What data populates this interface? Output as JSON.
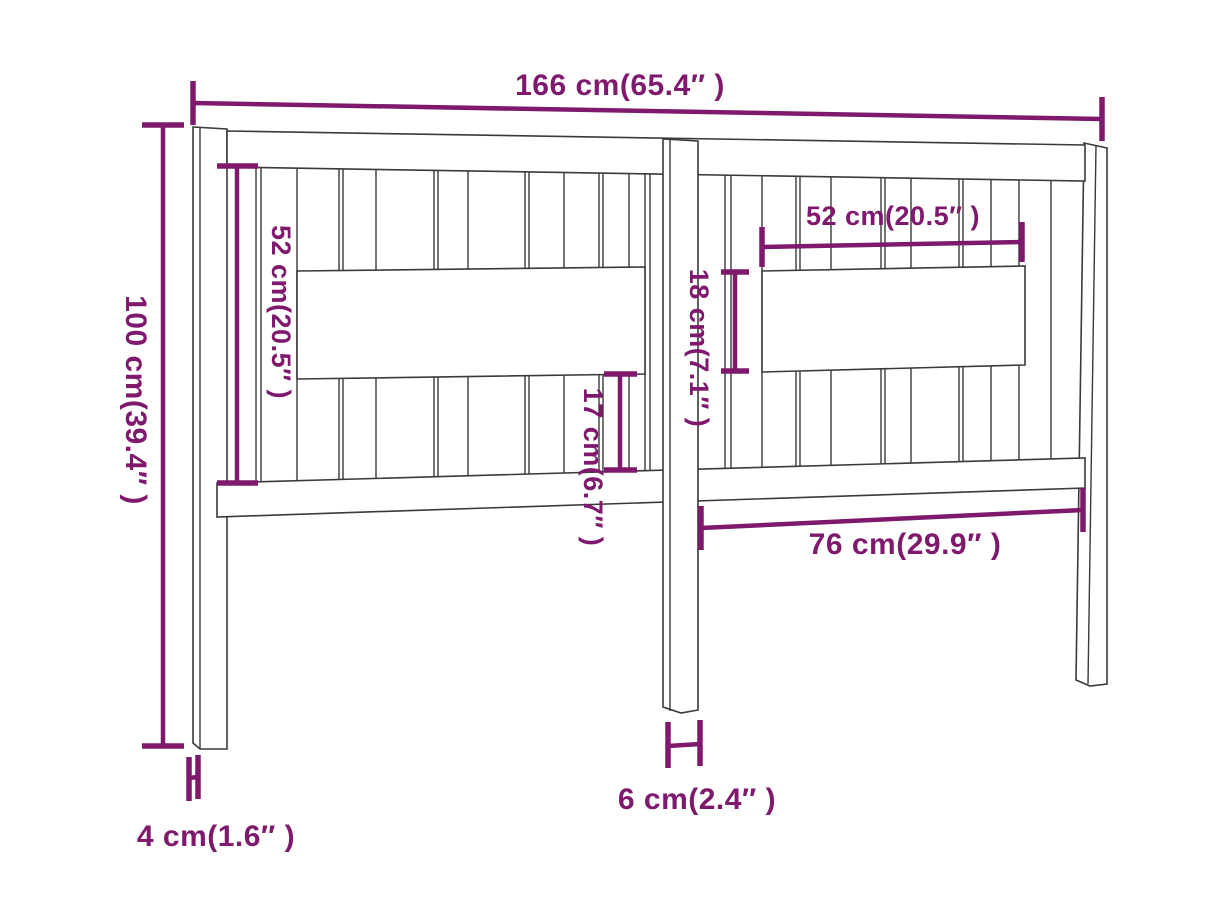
{
  "diagram": {
    "colors": {
      "dimension_accent": "#7E196D",
      "drawing_outline": "#3A3A3A",
      "background": "#FFFFFF"
    },
    "dimensions": {
      "overall_width": "166 cm(65.4″ )",
      "overall_height": "100 cm(39.4″ )",
      "left_opening_height": "52 cm(20.5″ )",
      "right_panel_width": "52 cm(20.5″ )",
      "right_panel_height": "18 cm(7.1″ )",
      "left_lower_height": "17 cm(6.7″ )",
      "lower_rail_span": "76 cm(29.9″ )",
      "center_leg_width": "6 cm(2.4″ )",
      "leg_thickness": "4 cm(1.6″ )"
    }
  }
}
